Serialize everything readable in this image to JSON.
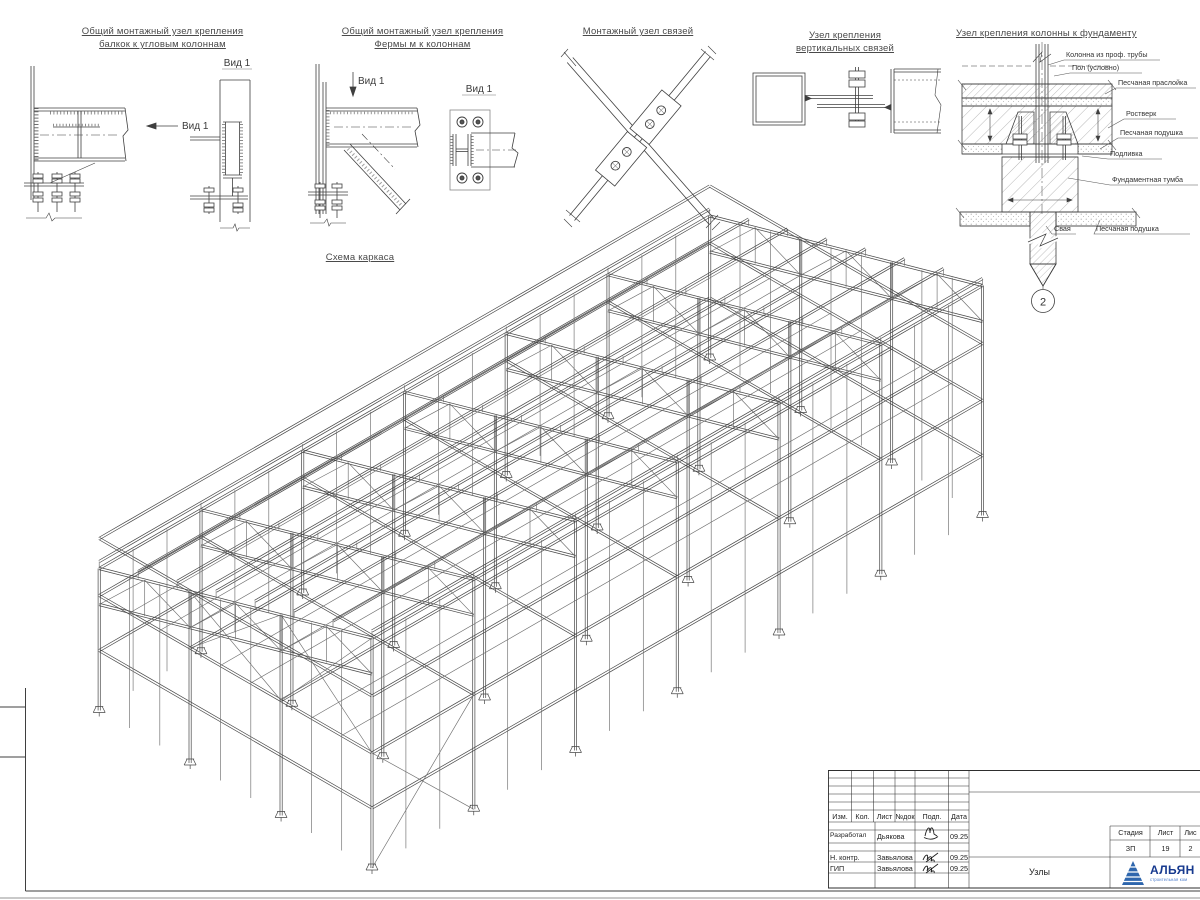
{
  "sheet": {
    "line_color": "#3f3f3f",
    "background": "#ffffff"
  },
  "scheme": {
    "title": "Схема каркаса"
  },
  "details": [
    {
      "t1": "Общий монтажный узел крепления",
      "t2": "балкок к угловым колоннам",
      "view": "Вид 1",
      "view2": "Вид 1"
    },
    {
      "t1": "Общий монтажный узел крепления",
      "t2": "Фермы м к колоннам",
      "view": "Вид 1",
      "view2": "Вид 1"
    },
    {
      "t1": "Монтажный узел связей"
    },
    {
      "t1": "Узел крепления",
      "t2": "вертикальных связей"
    },
    {
      "t1": "Узел крепления колонны к фундаменту",
      "marker": "2",
      "callouts": {
        "c1": "Колонна из проф. трубы",
        "c2": "Пол (условно)",
        "c3": "Песчаная праслойка",
        "c4": "Ростверк",
        "c5": "Песчаная подушка",
        "c6": "Подливка",
        "c7": "Фундаментная тумба",
        "c8": "Свая",
        "c9": "Песчаная подушка"
      }
    }
  ],
  "titleblock": {
    "headers": {
      "izm": "Изм.",
      "kol": "Кол.",
      "list": "Лист",
      "ndok": "№док",
      "podp": "Подп.",
      "data": "Дата"
    },
    "rows": {
      "r1_role": "Разработал",
      "r1_name": "Дьякова",
      "r1_date": "09.25",
      "r2_role": "Н. контр.",
      "r2_name": "Завьялова",
      "r2_date": "09.25",
      "r3_role": "ГИП",
      "r3_name": "Завьялова",
      "r3_date": "09.25"
    },
    "doc_title": "Узлы",
    "stage": {
      "label": "Стадия",
      "value": "ЗП"
    },
    "sheet_no": {
      "label": "Лист",
      "value": "19"
    },
    "sheets": {
      "label": "Лис",
      "value": "2"
    },
    "logo": {
      "text": "АЛЬЯН",
      "sub": "строительная ком",
      "color": "#173a8f",
      "tri": "#2e66ad"
    }
  }
}
